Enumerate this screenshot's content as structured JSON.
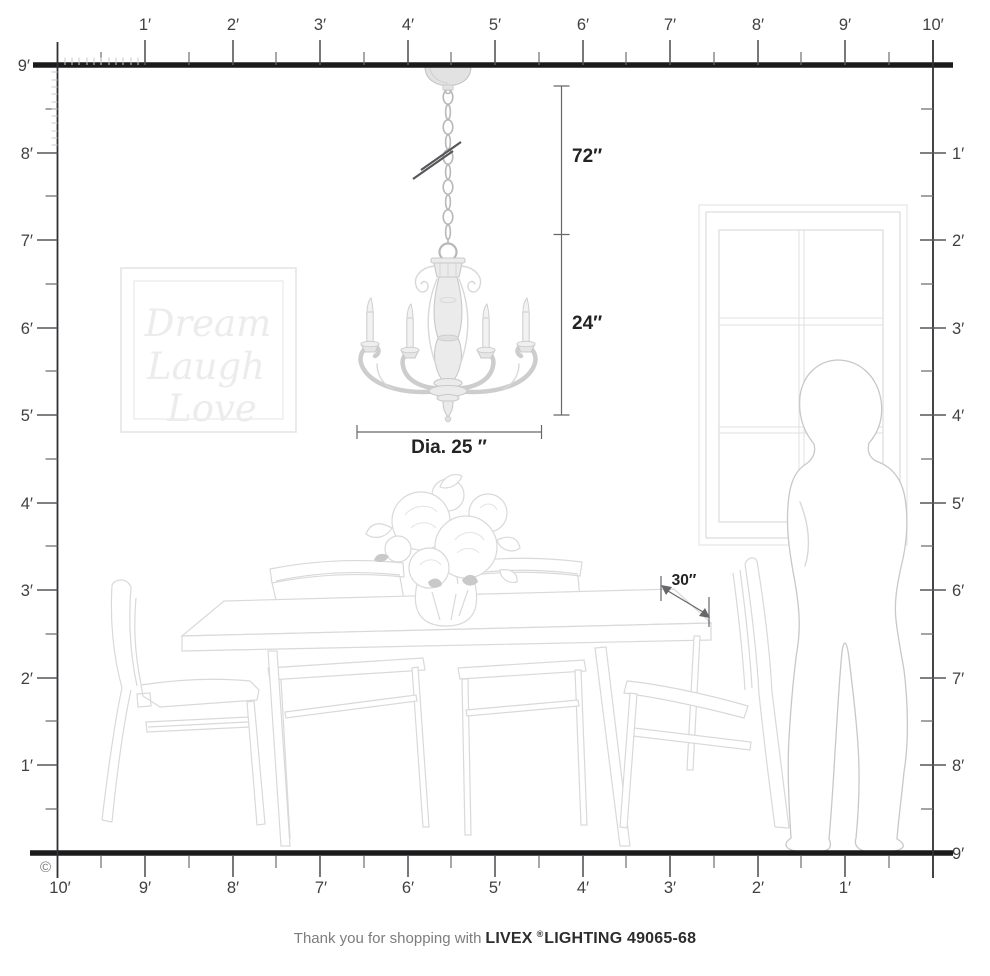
{
  "product": {
    "brand": "LIVEX",
    "registered": "®",
    "line_and_sku": "LIGHTING 49065-68"
  },
  "footer": {
    "prefix": "Thank you for shopping with",
    "brand": "LIVEX",
    "registered": "®",
    "suffix": "LIGHTING 49065-68"
  },
  "copyright": "©",
  "colors": {
    "structure_line": "#1b1b1d",
    "ruler_gray": "#55565a",
    "label_gray": "#414042",
    "dimension_text": "#232323",
    "furniture_lineart": "#d9d9d9",
    "chandelier_gray": "#c8c8c8"
  },
  "rulers": {
    "top": [
      "1′",
      "2′",
      "3′",
      "4′",
      "5′",
      "6′",
      "7′",
      "8′",
      "9′",
      "10′"
    ],
    "left": [
      "9′",
      "8′",
      "7′",
      "6′",
      "5′",
      "4′",
      "3′",
      "2′",
      "1′"
    ],
    "right": [
      "1′",
      "2′",
      "3′",
      "4′",
      "5′",
      "6′",
      "7′",
      "8′",
      "9′"
    ],
    "bottom": [
      "10′",
      "9′",
      "8′",
      "7′",
      "6′",
      "5′",
      "4′",
      "3′",
      "2′",
      "1′"
    ]
  },
  "dimensions": {
    "chain_overall": "72″",
    "fixture_height": "24″",
    "fixture_diameter": "Dia. 25 ″",
    "table_depth": "30″"
  },
  "wall_art": {
    "line1": "Dream",
    "line2": "Laugh",
    "line3": "Love"
  }
}
